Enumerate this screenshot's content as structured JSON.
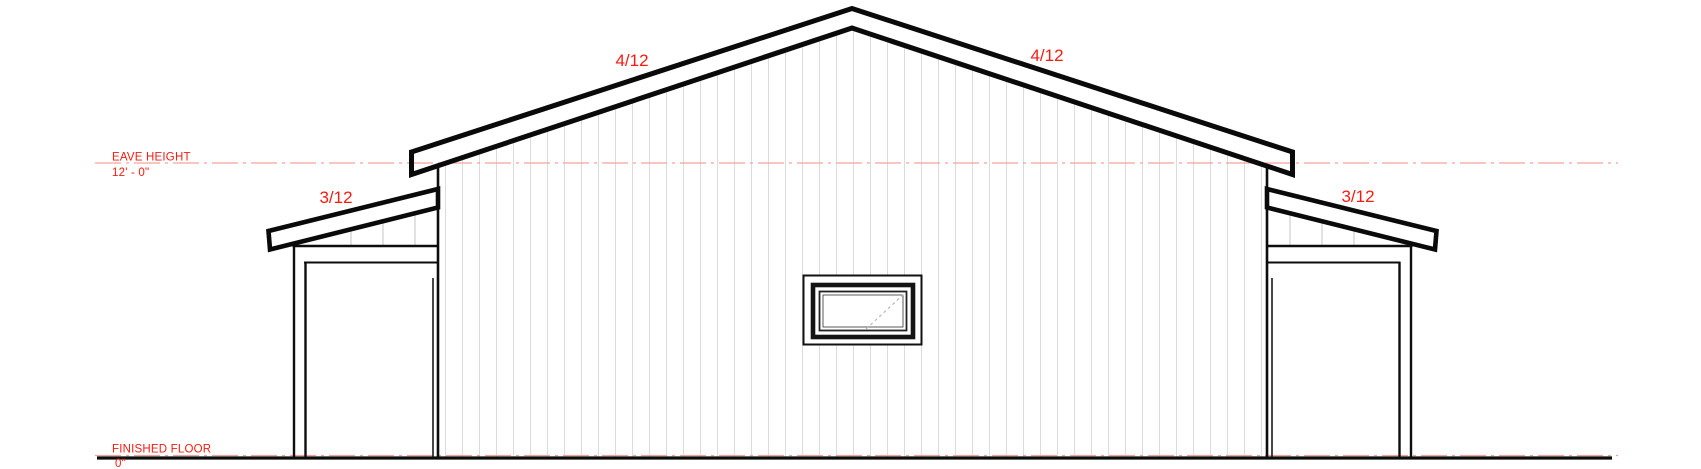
{
  "drawing": {
    "type": "building-end-elevation",
    "annotations": {
      "eave_height": {
        "label": "EAVE HEIGHT",
        "value": "12' - 0\""
      },
      "finished_floor": {
        "label": "FINISHED FLOOR",
        "value": "0\""
      }
    },
    "roof_pitches": {
      "main_left": "4/12",
      "main_right": "4/12",
      "lean_to_left": "3/12",
      "lean_to_right": "3/12"
    },
    "colors": {
      "annotation_red": "#fb1a10",
      "datum_pink": "#f2a39c",
      "line_black": "#0d0d0d",
      "siding_gray": "#dcdcdc",
      "wedge_siding_gray": "#cfcfcf",
      "background": "#ffffff"
    }
  }
}
